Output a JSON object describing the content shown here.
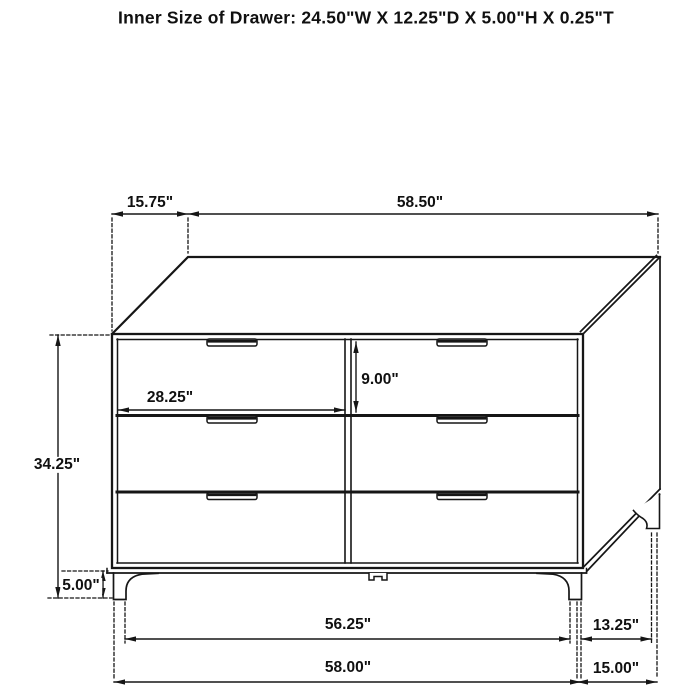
{
  "title": "Inner Size of Drawer: 24.50\"W X 12.25\"D X 5.00\"H X 0.25\"T",
  "inner_drawer_size": {
    "width": "24.50\"W",
    "depth": "12.25\"D",
    "height": "5.00\"H",
    "thickness": "0.25\"T"
  },
  "dims": {
    "top_depth": "15.75\"",
    "top_width": "58.50\"",
    "overall_height": "34.25\"",
    "leg_height": "5.00\"",
    "drawer_width": "28.25\"",
    "drawer_height": "9.00\"",
    "front_leg_span": "56.25\"",
    "side_leg_span": "13.25\"",
    "overall_width": "58.00\"",
    "overall_depth": "15.00\""
  },
  "subject": "six-drawer dresser dimension drawing",
  "colors": {
    "line": "#161616",
    "background": "#ffffff"
  }
}
